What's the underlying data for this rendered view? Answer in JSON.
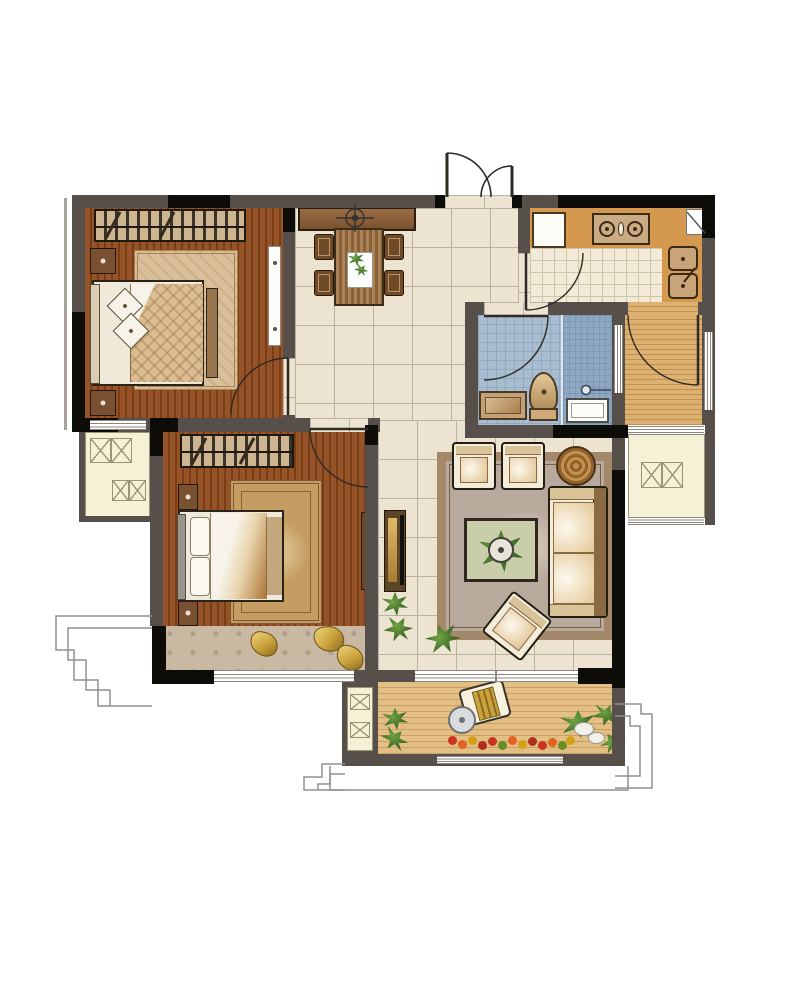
{
  "title": "Two-bedroom apartment floor plan (top-down rendered view, no text labels)",
  "palette": {
    "page_bg": "#ffffff",
    "wall": "#57504a",
    "wall_black": "#0e0c09",
    "wall_light": "#a9a29a",
    "tile": "#ece3d1",
    "tile_line": "#bab2a2",
    "wood_dark": "#95532a",
    "wood_dark_line": "#7a3d14",
    "wood_hall": "#ddb172",
    "wood_hall_line": "#c08f4c",
    "deck": "#e3bf85",
    "deck_line": "#c9a062",
    "counter": "#d4994e",
    "kitchen_floor": "#f3ebd7",
    "kitchen_floor_line": "#cfc5a8",
    "bath_floor": "#a9bdd0",
    "bath_floor_line": "#92a8be",
    "shower_floor": "#8ea7c2",
    "platform": "#f5f1d6",
    "platform_line": "#9a9473",
    "stone_seat": "#c9b8a2",
    "rug_master": "#d8bf99",
    "rug_master_border": "#a87f4e",
    "rug_second": "#c59d63",
    "rug_second_border": "#7e5731",
    "rug_living": "#b7a99c",
    "rug_living_band": "#a3896a",
    "furniture_wood": "#8a5f38",
    "furniture_wood_dark": "#5d4527",
    "outline": "#2b231a",
    "cream": "#f3ecdb",
    "tan": "#d9c49a",
    "gold": "#caa23c",
    "white": "#ffffff",
    "window_line": "#8d867d",
    "green": "#6fa344",
    "green_dark": "#2f5a1e"
  },
  "inventory": {
    "rooms": [
      "master-bedroom",
      "second-bedroom",
      "living-room",
      "dining-foyer",
      "kitchen",
      "bathroom",
      "laundry-hall",
      "south-balcony",
      "ac-platform-left",
      "ac-platform-right",
      "utility-shaft",
      "bay-window-seat"
    ],
    "furniture": [
      "double-bed",
      "wardrobe",
      "nightstand",
      "area-rug",
      "foot-bench",
      "dining-table",
      "dining-chair",
      "sideboard",
      "ceiling-light-symbol",
      "refrigerator",
      "cooktop",
      "kitchen-sink",
      "corner-cabinet",
      "toilet",
      "vanity",
      "shower",
      "shower-screen",
      "sofa",
      "armchair",
      "coffee-table",
      "tv-cabinet",
      "dresser",
      "round-side-table",
      "lounge-chair",
      "patio-table",
      "potted-plant",
      "flower-bed",
      "rocks",
      "gold-pillow",
      "radiator",
      "ac-unit-box",
      "entry-double-door",
      "interior-door"
    ]
  }
}
